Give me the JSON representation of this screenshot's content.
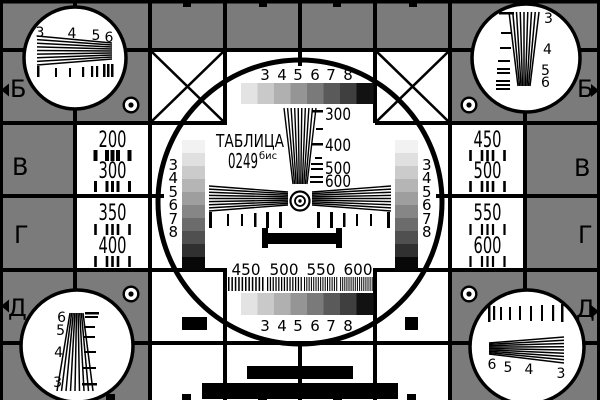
{
  "card": {
    "title": "ТАБЛИЦА",
    "number": "0249",
    "suffix": "бис"
  },
  "rows": {
    "left": [
      "Б",
      "В",
      "Г",
      "Д"
    ],
    "right": [
      "Б",
      "В",
      "Г",
      "Д"
    ]
  },
  "cells": {
    "left_upper": [
      "200",
      "300"
    ],
    "left_lower": [
      "350",
      "400"
    ],
    "right_upper": [
      "450",
      "500"
    ],
    "right_lower": [
      "550",
      "600"
    ]
  },
  "center": {
    "grayscale_top": [
      "3",
      "4",
      "5",
      "6",
      "7",
      "8"
    ],
    "grayscale_bottom": [
      "3",
      "4",
      "5",
      "6",
      "7",
      "8"
    ],
    "wedge_labels": [
      "300",
      "400",
      "500",
      "600"
    ],
    "burst_labels": [
      "450",
      "500",
      "550",
      "600"
    ],
    "staircase_left": [
      "3",
      "4",
      "5",
      "6",
      "7",
      "8"
    ],
    "staircase_right": [
      "3",
      "4",
      "5",
      "6",
      "7",
      "8"
    ]
  },
  "corners": {
    "top_left": [
      "3",
      "4",
      "5",
      "6"
    ],
    "top_right": [
      "3",
      "4",
      "5",
      "6"
    ],
    "bottom_left": [
      "6",
      "5",
      "4",
      "3"
    ],
    "bottom_right": [
      "6",
      "5",
      "4",
      "3"
    ]
  },
  "colors": {
    "background": "#7b7b7b",
    "line": "#000000",
    "white": "#ffffff",
    "step_shades": [
      "#e3e3e3",
      "#c9c9c9",
      "#b0b0b0",
      "#959595",
      "#7a7a7a",
      "#5a5a5a",
      "#3f3f3f",
      "#121212"
    ],
    "staircase_shades": [
      "#f2f2f2",
      "#e0e0e0",
      "#cbcbcb",
      "#b5b5b5",
      "#9e9e9e",
      "#868686",
      "#6c6c6c",
      "#505050",
      "#303030",
      "#080808"
    ]
  },
  "edge_marks": {
    "top_x": [
      187,
      263,
      337,
      413
    ],
    "bottom_x": [
      110,
      186,
      262,
      337,
      411
    ]
  }
}
